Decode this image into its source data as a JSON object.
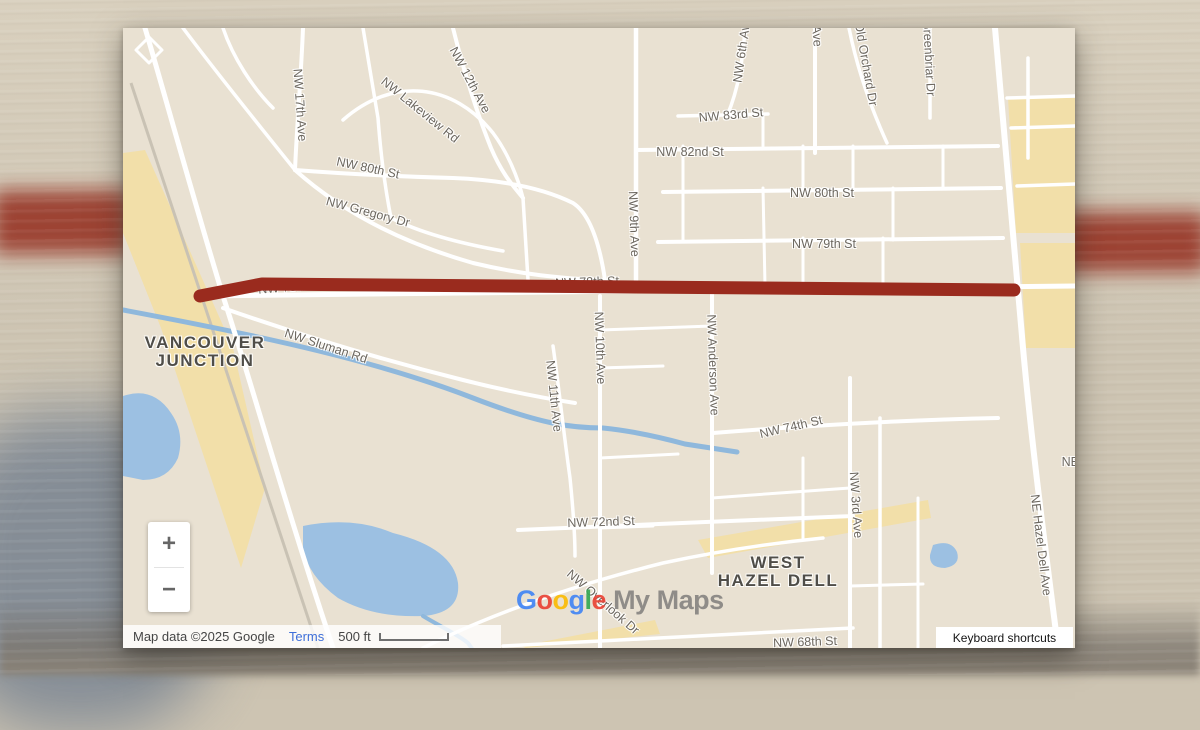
{
  "background": {
    "base": "#cdc4b2",
    "red_stripe": "#963122",
    "blue_corner": "#7e8894"
  },
  "map": {
    "bg": "#e9e1d2",
    "road_color": "#ffffff",
    "water_color": "#9cc0e2",
    "creek_color": "#8fb8dc",
    "tan_color": "#f2dfa9",
    "railway_color": "#c9c2b4",
    "route": {
      "color": "#9a2b1e",
      "width": 13,
      "path": "M77,268 L139,256 L891,262"
    },
    "tan_polys": [
      "M0,125 L22,122 L110,320 L142,460 L118,540 L92,462 L38,300 L0,205 Z",
      "M885,70 L952,70 L952,205 L893,205 Z",
      "M897,215 L952,215 L952,320 L903,320 Z",
      "M575,512 L805,472 L808,490 L585,530 Z",
      "M398,618 L532,592 L537,606 L403,620 Z"
    ],
    "water_polys": [
      "M0,368 Q30,358 48,385 Q62,405 55,430 Q45,452 20,452 L0,448 Z",
      "M180,498 Q230,488 270,505 Q330,520 335,555 Q338,585 300,588 Q250,590 215,570 Q185,548 180,520 Z",
      "M810,517 Q828,511 834,524 Q838,537 822,540 Q806,540 807,527 Z"
    ],
    "water_lines": [
      {
        "d": "M0,282 C150,310 260,335 350,370 C420,397 450,400 480,400 C510,403 540,410 562,416 L614,424",
        "w": 5
      },
      {
        "d": "M300,588 C320,600 334,606 345,615 L350,622",
        "w": 4
      }
    ],
    "railway": {
      "d": "M8,55 L195,620",
      "w": 3
    },
    "roads": [
      {
        "d": "M22,0 C40,60 70,170 100,268 C130,360 160,470 210,620",
        "w": 5
      },
      {
        "d": "M180,0 C178,50 174,95 172,142",
        "w": 4
      },
      {
        "d": "M60,0 C90,40 130,90 172,142",
        "w": 3.5
      },
      {
        "d": "M172,142 C220,185 280,215 350,235 C400,247 440,250 470,252",
        "w": 4
      },
      {
        "d": "M172,142 C210,145 260,148 330,150 C380,152 420,160 450,175 C470,188 478,225 482,252",
        "w": 4
      },
      {
        "d": "M220,92 C270,48 330,55 370,105 C385,125 395,150 400,170",
        "w": 3.5
      },
      {
        "d": "M330,0 C340,40 352,80 368,120 C380,148 392,160 400,170",
        "w": 4
      },
      {
        "d": "M400,170 L405,252",
        "w": 3.5
      },
      {
        "d": "M100,0 C110,30 130,60 150,80",
        "w": 3.5
      },
      {
        "d": "M240,0 C245,30 250,60 255,90 C258,130 262,160 268,190 C300,206 340,216 380,223",
        "w": 3.5
      },
      {
        "d": "M513,0 L513,252",
        "w": 4.5
      },
      {
        "d": "M477,268 L477,620",
        "w": 4
      },
      {
        "d": "M430,318 C436,360 440,400 447,450 C450,480 452,505 452,528",
        "w": 3.5
      },
      {
        "d": "M589,262 L589,545",
        "w": 4
      },
      {
        "d": "M622,0 C620,30 616,60 604,88",
        "w": 3.5
      },
      {
        "d": "M692,0 L692,125",
        "w": 4
      },
      {
        "d": "M726,0 C734,40 748,80 764,115",
        "w": 3.5
      },
      {
        "d": "M807,0 L807,90",
        "w": 3.5
      },
      {
        "d": "M727,350 L727,620",
        "w": 4
      },
      {
        "d": "M872,0 C880,90 890,200 900,320 C910,430 925,540 935,620",
        "w": 6
      },
      {
        "d": "M555,88 L645,86",
        "w": 3.5
      },
      {
        "d": "M513,122 L875,118",
        "w": 4
      },
      {
        "d": "M540,164 L878,160",
        "w": 4
      },
      {
        "d": "M894,158 L952,156",
        "w": 3.5
      },
      {
        "d": "M535,214 L880,210",
        "w": 4
      },
      {
        "d": "M77,268 L952,258",
        "w": 5
      },
      {
        "d": "M100,280 C180,308 260,332 340,352 C380,362 420,370 452,375",
        "w": 4
      },
      {
        "d": "M590,405 C680,398 780,392 875,390",
        "w": 4
      },
      {
        "d": "M395,502 C500,498 620,492 730,488",
        "w": 4
      },
      {
        "d": "M380,618 C480,612 600,606 730,600",
        "w": 3.5
      },
      {
        "d": "M300,620 C360,590 440,560 540,535 C600,522 650,515 700,510",
        "w": 3.5
      },
      {
        "d": "M905,30 L905,130",
        "w": 3.5
      },
      {
        "d": "M884,70 L952,68",
        "w": 3.5
      },
      {
        "d": "M888,100 L952,98",
        "w": 3.5
      },
      {
        "d": "M560,118 L560,212",
        "w": 3
      },
      {
        "d": "M640,86 L640,118",
        "w": 3
      },
      {
        "d": "M680,118 L680,162",
        "w": 3
      },
      {
        "d": "M730,118 L730,162",
        "w": 3
      },
      {
        "d": "M770,160 L770,212",
        "w": 3
      },
      {
        "d": "M820,118 L820,160",
        "w": 3
      },
      {
        "d": "M680,210 L680,258",
        "w": 3
      },
      {
        "d": "M760,210 L760,258",
        "w": 3
      },
      {
        "d": "M640,160 L642,258",
        "w": 3
      },
      {
        "d": "M477,302 L589,298",
        "w": 3
      },
      {
        "d": "M477,340 L540,338",
        "w": 3
      },
      {
        "d": "M477,430 L555,426",
        "w": 3
      },
      {
        "d": "M477,500 L530,498",
        "w": 3
      },
      {
        "d": "M589,470 C640,466 700,462 727,460",
        "w": 3
      },
      {
        "d": "M757,390 L757,620",
        "w": 3.5
      },
      {
        "d": "M795,470 L795,620",
        "w": 3
      },
      {
        "d": "M680,430 L680,510",
        "w": 3
      },
      {
        "d": "M727,558 L800,556",
        "w": 3
      },
      {
        "d": "M13,22 L26,9 L39,22 L26,35 Z",
        "w": 3
      }
    ],
    "street_labels": [
      {
        "text": "NW 17th Ave",
        "x": 177,
        "y": 77,
        "rot": 86
      },
      {
        "text": "NW Lakeview Rd",
        "x": 297,
        "y": 82,
        "rot": 39
      },
      {
        "text": "NW 12th Ave",
        "x": 347,
        "y": 52,
        "rot": 62
      },
      {
        "text": "NW 80th St",
        "x": 245,
        "y": 140,
        "rot": 12
      },
      {
        "text": "NW Gregory Dr",
        "x": 245,
        "y": 184,
        "rot": 15
      },
      {
        "text": "NW 6th Ave",
        "x": 619,
        "y": 22,
        "rot": -82
      },
      {
        "text": "Ave",
        "x": 694,
        "y": 8,
        "rot": 86
      },
      {
        "text": "Old Orchard Dr",
        "x": 743,
        "y": 36,
        "rot": 80
      },
      {
        "text": "Greenbriar Dr",
        "x": 806,
        "y": 30,
        "rot": 87
      },
      {
        "text": "NW 83rd St",
        "x": 608,
        "y": 87,
        "rot": -5
      },
      {
        "text": "NW 82nd St",
        "x": 567,
        "y": 124,
        "rot": 0
      },
      {
        "text": "NW 80th St",
        "x": 699,
        "y": 165,
        "rot": 0
      },
      {
        "text": "NW 79th St",
        "x": 701,
        "y": 216,
        "rot": 0
      },
      {
        "text": "NW 78th St",
        "x": 167,
        "y": 259,
        "rot": -5
      },
      {
        "text": "NW 78th St",
        "x": 464,
        "y": 254,
        "rot": -2
      },
      {
        "text": "NW 9th Ave",
        "x": 511,
        "y": 196,
        "rot": 88
      },
      {
        "text": "NW 10th Ave",
        "x": 477,
        "y": 320,
        "rot": 88
      },
      {
        "text": "NW 11th Ave",
        "x": 431,
        "y": 368,
        "rot": 84
      },
      {
        "text": "NW Anderson Ave",
        "x": 590,
        "y": 337,
        "rot": 88
      },
      {
        "text": "NW Sluman Rd",
        "x": 203,
        "y": 318,
        "rot": 18
      },
      {
        "text": "NW 74th St",
        "x": 668,
        "y": 399,
        "rot": -13
      },
      {
        "text": "NW 72nd St",
        "x": 478,
        "y": 494,
        "rot": -2
      },
      {
        "text": "NW 68th St",
        "x": 682,
        "y": 614,
        "rot": -2
      },
      {
        "text": "NW Overlook Dr",
        "x": 480,
        "y": 574,
        "rot": 41
      },
      {
        "text": "NW 3rd Ave",
        "x": 733,
        "y": 477,
        "rot": 86
      },
      {
        "text": "NE Hazel Dell Ave",
        "x": 918,
        "y": 517,
        "rot": 83
      },
      {
        "text": "NE Hazel",
        "x": 965,
        "y": 434,
        "rot": 0
      }
    ],
    "city_labels": [
      {
        "lines": [
          "VANCOUVER",
          "JUNCTION"
        ],
        "x": 82,
        "y": 324
      },
      {
        "lines": [
          "WEST",
          "HAZEL DELL"
        ],
        "x": 655,
        "y": 544
      }
    ]
  },
  "controls": {
    "zoom_in": "+",
    "zoom_out": "−"
  },
  "attribution": {
    "map_data": "Map data ©2025 Google",
    "terms": "Terms",
    "scale_text": "500 ft",
    "keyboard_shortcuts": "Keyboard shortcuts"
  },
  "watermark": {
    "letters": [
      {
        "ch": "G",
        "color": "#4285F4"
      },
      {
        "ch": "o",
        "color": "#EA4335"
      },
      {
        "ch": "o",
        "color": "#FBBC05"
      },
      {
        "ch": "g",
        "color": "#4285F4"
      },
      {
        "ch": "l",
        "color": "#34A853"
      },
      {
        "ch": "e",
        "color": "#EA4335"
      }
    ],
    "suffix": "My Maps"
  }
}
